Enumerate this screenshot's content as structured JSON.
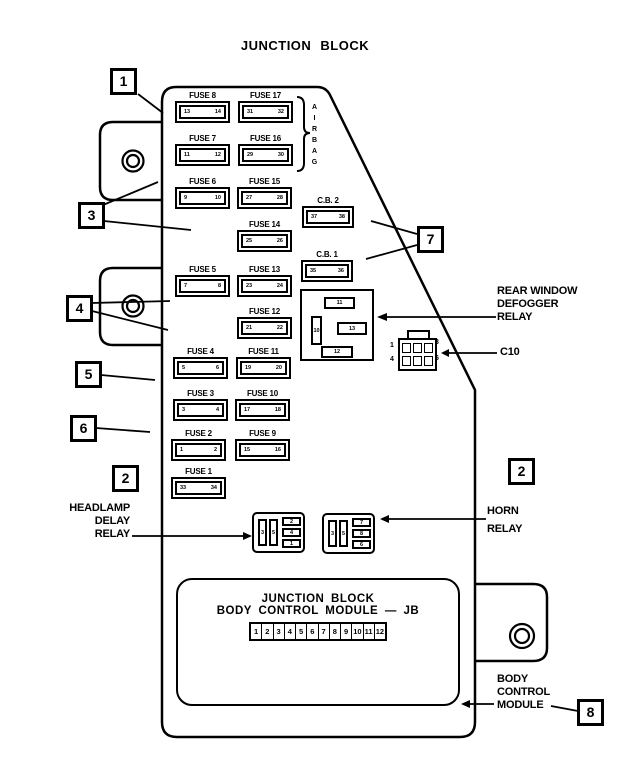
{
  "title": "JUNCTION BLOCK",
  "airbag": {
    "letters": [
      "A",
      "I",
      "R",
      "B",
      "A",
      "G"
    ]
  },
  "callouts": {
    "c1": "1",
    "c3": "3",
    "c4": "4",
    "c5": "5",
    "c6": "6",
    "c2_left": "2",
    "c7": "7",
    "c2_right": "2",
    "c8": "8"
  },
  "slots": [
    {
      "label": "FUSE 8",
      "a": "13",
      "b": "14"
    },
    {
      "label": "FUSE 7",
      "a": "11",
      "b": "12"
    },
    {
      "label": "FUSE 6",
      "a": "9",
      "b": "10"
    },
    {
      "label": "FUSE 5",
      "a": "7",
      "b": "8"
    },
    {
      "label": "FUSE 4",
      "a": "5",
      "b": "6"
    },
    {
      "label": "FUSE 3",
      "a": "3",
      "b": "4"
    },
    {
      "label": "FUSE 2",
      "a": "1",
      "b": "2"
    },
    {
      "label": "FUSE 1",
      "a": "33",
      "b": "34"
    },
    {
      "label": "FUSE 17",
      "a": "31",
      "b": "32"
    },
    {
      "label": "FUSE 16",
      "a": "29",
      "b": "30"
    },
    {
      "label": "FUSE 15",
      "a": "27",
      "b": "28"
    },
    {
      "label": "FUSE 14",
      "a": "25",
      "b": "26"
    },
    {
      "label": "FUSE 13",
      "a": "23",
      "b": "24"
    },
    {
      "label": "FUSE 12",
      "a": "21",
      "b": "22"
    },
    {
      "label": "FUSE 11",
      "a": "19",
      "b": "20"
    },
    {
      "label": "FUSE 10",
      "a": "17",
      "b": "18"
    },
    {
      "label": "FUSE 9",
      "a": "15",
      "b": "16"
    },
    {
      "label": "C.B. 2",
      "a": "37",
      "b": "38"
    },
    {
      "label": "C.B. 1",
      "a": "35",
      "b": "36"
    }
  ],
  "defogger_relay": {
    "top": "11",
    "left": "10",
    "middle": "13",
    "bottom": "12"
  },
  "c10": {
    "label": "C10",
    "pins": {
      "p1": "1",
      "p3": "3",
      "p4": "4",
      "p6": "6"
    }
  },
  "relays": {
    "headlamp": {
      "v1": "3",
      "v2": "5",
      "h1": "2",
      "h2": "4",
      "h3": "1"
    },
    "horn": {
      "v1": "3",
      "v2": "5",
      "h1": "7",
      "h2": "8",
      "h3": "6"
    }
  },
  "labels": {
    "headlamp": {
      "l1": "HEADLAMP",
      "l2": "DELAY",
      "l3": "RELAY"
    },
    "defogger": {
      "l1": "REAR  WINDOW",
      "l2": "DEFOGGER",
      "l3": "RELAY"
    },
    "horn": {
      "l1": "HORN",
      "l2": "RELAY"
    },
    "bcm": {
      "l1": "BODY",
      "l2": "CONTROL",
      "l3": "MODULE"
    }
  },
  "bcm_panel": {
    "line1": "JUNCTION BLOCK",
    "line2": "BODY CONTROL MODULE — JB",
    "pins": [
      "1",
      "2",
      "3",
      "4",
      "5",
      "6",
      "7",
      "8",
      "9",
      "10",
      "11",
      "12"
    ]
  }
}
